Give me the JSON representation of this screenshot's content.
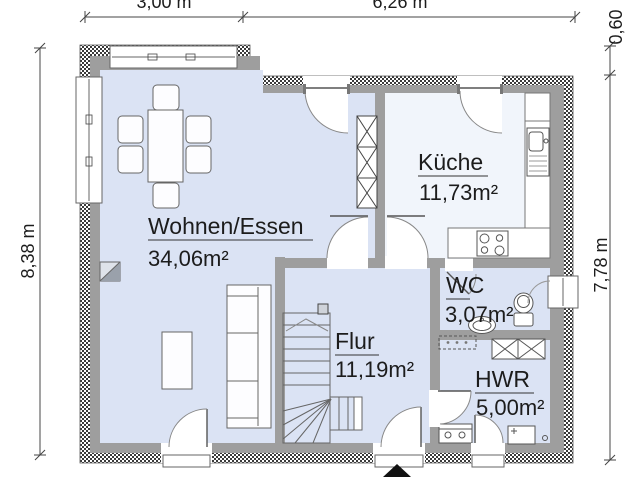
{
  "plan": {
    "title": "Grundriss Erdgeschoss",
    "rooms": {
      "wohnen": {
        "name": "Wohnen/Essen",
        "area": "34,06m²"
      },
      "kueche": {
        "name": "Küche",
        "area": "11,73m²"
      },
      "wc": {
        "name": "WC",
        "area": "3,07m²"
      },
      "flur": {
        "name": "Flur",
        "area": "11,19m²"
      },
      "hwr": {
        "name": "HWR",
        "area": "5,00m²"
      }
    },
    "dimensions": {
      "top_left": "3,00 m",
      "top_right": "6,26 m",
      "left": "8,38 m",
      "right": "7,78 m",
      "right_top": "0,60"
    },
    "colors": {
      "floor": "#dbe3f4",
      "kitchen_floor": "#f1f5fb",
      "wall_gray": "#9e9e9e",
      "hatch_dark": "#3a3a3a"
    }
  }
}
